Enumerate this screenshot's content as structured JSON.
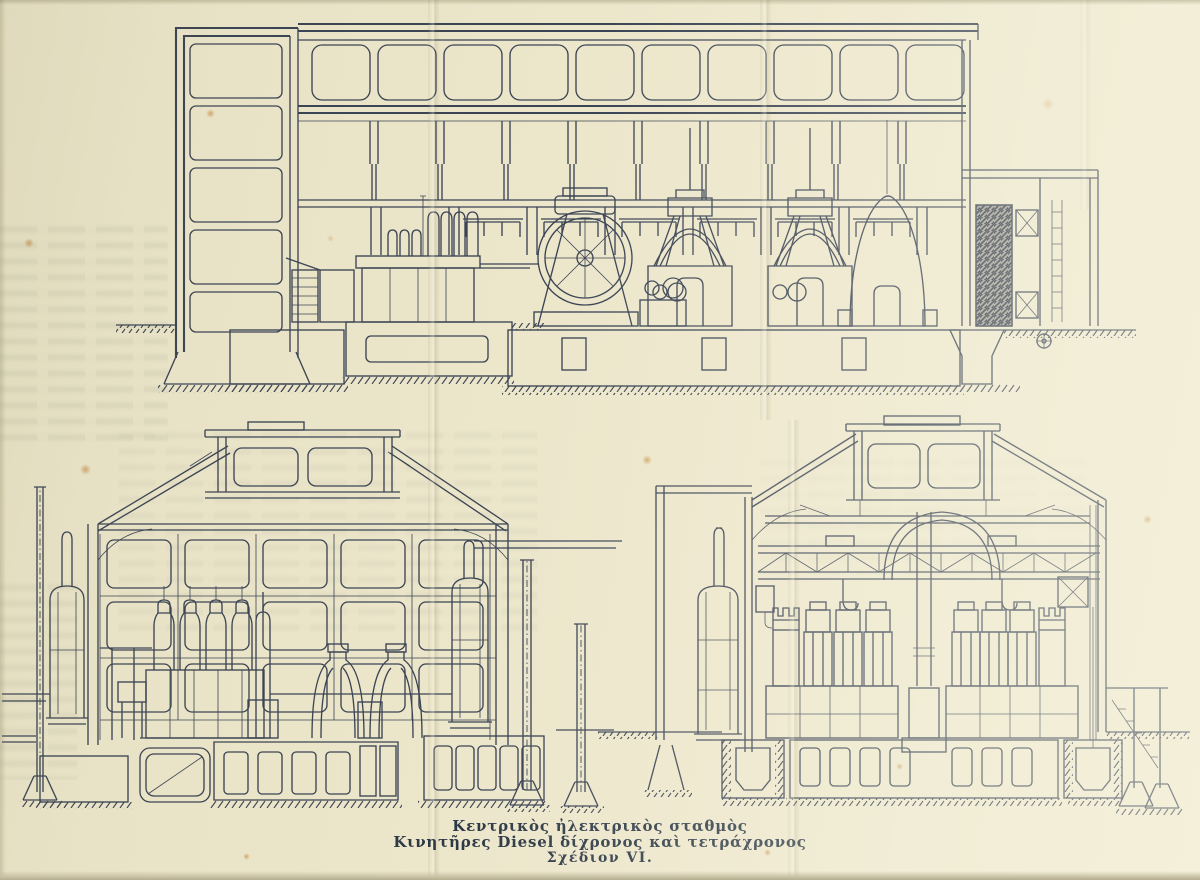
{
  "caption": {
    "line1": "Κεντρικὸς ἠλεκτρικὸς σταθμὸς",
    "line2": "Κινητῆρες Diesel δίχρονος καὶ τετράχρονος",
    "line3": "Σχέδιον VI."
  },
  "colors": {
    "paper": "#ece6cb",
    "ink": "#3b4454",
    "caption_ink": "#2d3946"
  }
}
